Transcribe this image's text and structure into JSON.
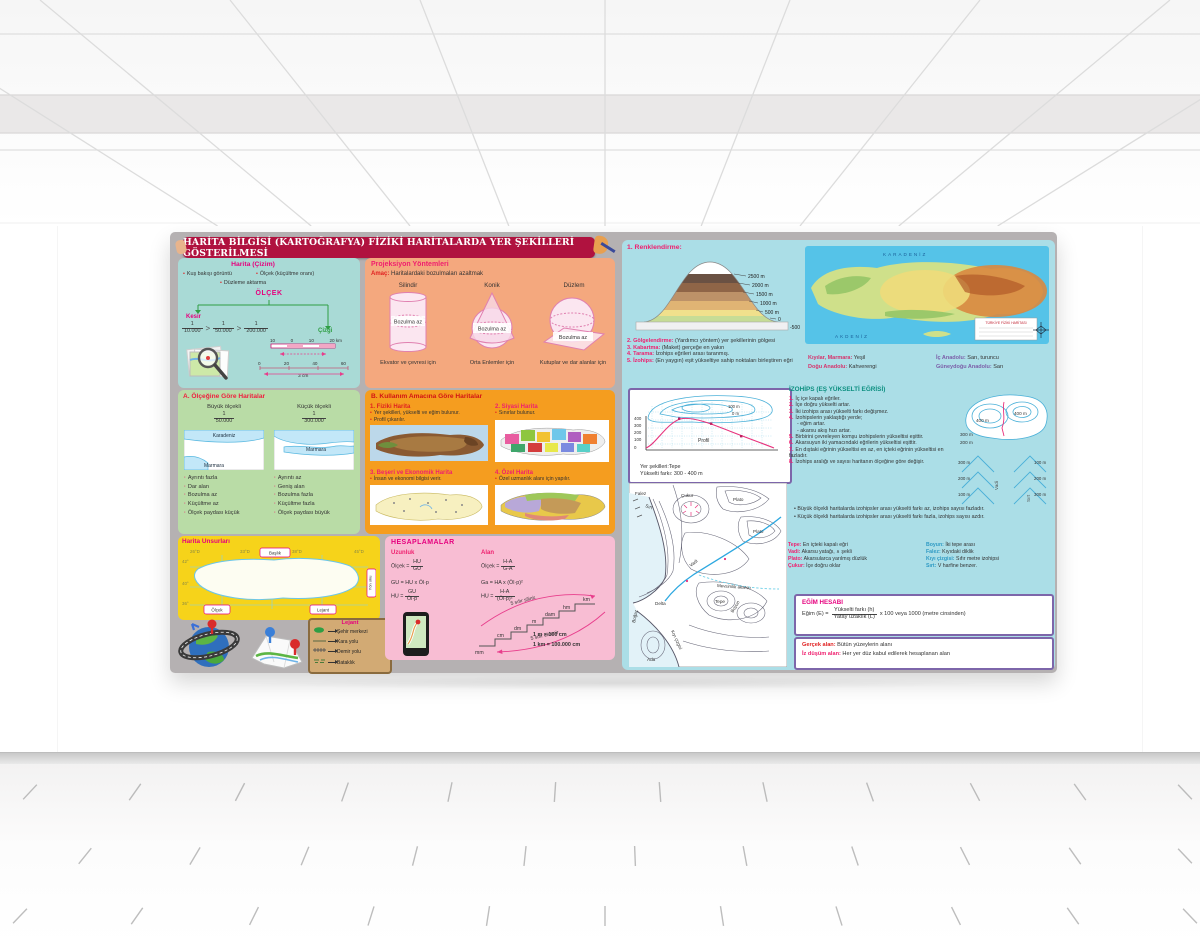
{
  "poster": {
    "title": "HARİTA BİLGİSİ (KARTOĞRAFYA) FİZİKİ HARİTALARDA YER ŞEKİLLERİ GÖSTERİLMESİ",
    "harita_cizim": {
      "title": "Harita (Çizim)",
      "bullets": [
        "Kuş bakışı görüntü",
        "Ölçek (küçültme oranı)",
        "Düzleme aktarma"
      ],
      "olcek": "ÖLÇEK",
      "kesir": "Kesir",
      "cizgi": "Çizgi",
      "sep": ">",
      "fractions": [
        {
          "num": "1",
          "den": "10.000"
        },
        {
          "num": "1",
          "den": "50.000"
        },
        {
          "num": "1",
          "den": "200.000"
        }
      ],
      "bar1": {
        "ticks": [
          "10",
          "0",
          "10",
          "20 km"
        ],
        "note": "3 cm"
      },
      "bar2": {
        "ticks": [
          "0",
          "20",
          "40",
          "60"
        ],
        "note": "6 cm"
      }
    },
    "olcegine": {
      "title": "A. Ölçeğine Göre Haritalar",
      "left": {
        "heading": "Büyük ölçekli",
        "num": "1",
        "den": "50.000",
        "sea_top": "Karadeniz",
        "sea_bottom": "Marmara",
        "bullets": [
          "Ayrıntı fazla",
          "Dar alan",
          "Bozulma az",
          "Küçültme az",
          "Ölçek paydası küçük"
        ]
      },
      "right": {
        "heading": "Küçük ölçekli",
        "num": "1",
        "den": "300.000",
        "sea_mid": "Marmara",
        "bullets": [
          "Ayrıntı az",
          "Geniş alan",
          "Bozulma fazla",
          "Küçültme fazla",
          "Ölçek paydası büyük"
        ]
      }
    },
    "unsurlar": {
      "title": "Harita Unsurları",
      "top_coords": [
        "26°D",
        "33°D",
        "38°D",
        "45°D"
      ],
      "left_coords": [
        "42°",
        "40°",
        "36°"
      ],
      "baslik": "Başlık",
      "olcek": "Ölçek",
      "lejant": "Lejant",
      "yon": "Yön oku"
    },
    "lejant": {
      "title": "Lejant",
      "items": [
        "Şehir merkezi",
        "Kara yolu",
        "Demir yolu",
        "Bataklık"
      ]
    },
    "projeksiyon": {
      "title": "Projeksiyon Yöntemleri",
      "amac_label": "Amaç:",
      "amac": "Haritalardaki bozulmaları azaltmak",
      "methods": [
        {
          "name": "Silindir",
          "note": "Bozulma az",
          "caption": "Ekvator ve çevresi için"
        },
        {
          "name": "Konik",
          "note": "Bozulma az",
          "caption": "Orta Enlemler için"
        },
        {
          "name": "Düzlem",
          "note": "Bozulma az",
          "caption": "Kutuplar ve dar alanlar için"
        }
      ]
    },
    "kullanim": {
      "title": "B. Kullanım Amacına Göre Haritalar",
      "items": [
        {
          "name": "1. Fiziki Harita",
          "b1": "Yer şekilleri, yükselti ve eğim bulunur.",
          "b2": "Profil çıkarılır."
        },
        {
          "name": "2. Siyasi Harita",
          "b1": "Sınırlar bulunur."
        },
        {
          "name": "3. Beşeri ve Ekonomik Harita",
          "b1": "İnsan ve ekonomi bilgisi verir."
        },
        {
          "name": "4. Özel Harita",
          "b1": "Özel uzmanlık alanı için yapılır."
        }
      ]
    },
    "hesaplamalar": {
      "title": "HESAPLAMALAR",
      "uzunluk": "Uzunluk",
      "alan": "Alan",
      "u1": {
        "lhs": "Ölçek =",
        "num": "HU",
        "den": "GU"
      },
      "u2": "GU = HU x Öl·p",
      "u3": {
        "lhs": "HU =",
        "num": "GU",
        "den": "Öl·p"
      },
      "a1": {
        "lhs": "Ölçek =",
        "num": "H-A",
        "den": "G-A"
      },
      "a2": "Ga = HA x (Öl·p)²",
      "a3": {
        "lhs": "HU =",
        "num": "H-A",
        "den": "(Öl·p)²"
      },
      "stairs": [
        "mm",
        "cm",
        "dm",
        "m",
        "dam",
        "hm",
        "km"
      ],
      "up": "5 sıfır silinir.",
      "down": "5 sıfır eklenir.",
      "eq1": "1 m = 100 cm",
      "eq2": "1 km = 100.000 cm"
    },
    "renklendirme": {
      "title": "1. Renklendirme:",
      "labels": [
        "2500 m",
        "2000 m",
        "1500 m",
        "1000 m",
        "500 m",
        "0",
        "-500"
      ]
    },
    "yontemler": [
      {
        "label": "2. Gölgelendirme:",
        "text": "(Yardımcı yöntem) yer şekillerinin gölgesi"
      },
      {
        "label": "3. Kabartma:",
        "text": "(Maket) gerçeğe en yakın"
      },
      {
        "label": "4. Tarama:",
        "text": "İzohips eğrileri arası taranmış."
      },
      {
        "label": "5. İzohips:",
        "text": "(En yaygın) eşit yükseltiye sahip noktaları birleştiren eğri"
      }
    ],
    "renk_anahtari": [
      {
        "label": "Kıyılar, Marmara:",
        "value": "Yeşil"
      },
      {
        "label": "İç Anadolu:",
        "value": "Sarı, turuncu"
      },
      {
        "label": "Doğu Anadolu:",
        "value": "Kahverengi"
      },
      {
        "label": "Güneydoğu Anadolu:",
        "value": "Sarı"
      }
    ],
    "fiziki_harita": {
      "sea_top": "KARADENİZ",
      "sea_bottom": "AKDENİZ",
      "legend_title": "TÜRKİYE FİZİKİ HARİTASI"
    },
    "profil": {
      "c100": "100 m",
      "c0": "0 m",
      "axis": [
        "400",
        "300",
        "200",
        "100",
        "0"
      ],
      "label": "Profil",
      "cap1": "Yer şekilleri:Tepe",
      "cap2": "Yükselti farkı: 300 - 400 m"
    },
    "izohips": {
      "title": "İZOHİPS (EŞ YÜKSELTİ EĞRİSİ)",
      "items": [
        {
          "n": "1.",
          "t": "İç içe kapalı eğriler."
        },
        {
          "n": "2.",
          "t": "İçe doğru yükselti artar."
        },
        {
          "n": "3.",
          "t": "İki izohips arası yükselti farkı değişmez."
        },
        {
          "n": "4.",
          "t": "İzohipslerin yaklaştığı yerde;",
          "s1": "- eğim artar.",
          "s2": "- akarsu akış hızı artar."
        },
        {
          "n": "5.",
          "t": "Birbirini çevreleyen komşu izohipslerin yükseltisi eşittir."
        },
        {
          "n": "6.",
          "t": "Akarsuyun iki yamacındaki eğrilerin yükseltisi eşittir."
        },
        {
          "n": "7.",
          "t": "En dıştaki eğrinin yükseltisi en az, en içteki eğrinin yükseltisi en fazladır."
        },
        {
          "n": "8.",
          "t": "İzohips aralığı ve sayısı haritanın ölçeğine göre değişir."
        }
      ],
      "sub1": "• Büyük ölçekli haritalarda izohipsler arası yükselti farkı az, izohips sayısı fazladır.",
      "sub2": "• Küçük ölçekli haritalarda izohipsler arası yükselti farkı fazla, izohips sayısı azdır.",
      "hill_labels": [
        "400 m",
        "300 m",
        "200 m",
        "400 m"
      ],
      "vadi": {
        "label": "Vadi",
        "marks": [
          "300 m",
          "200 m",
          "100 m"
        ]
      },
      "sirt": {
        "label": "Sırt",
        "marks": [
          "100 m",
          "200 m",
          "300 m"
        ]
      }
    },
    "tanimlar": {
      "left": [
        {
          "k": "Tepe:",
          "v": "En içteki kapalı eğri"
        },
        {
          "k": "Vadi:",
          "v": "Akarsu yatağı, ∧ şekli"
        },
        {
          "k": "Plato:",
          "v": "Akarsularca yarılmış düzlük"
        },
        {
          "k": "Çukur:",
          "v": "İçe doğru oklar"
        }
      ],
      "right": [
        {
          "k": "Boyun:",
          "v": "İki tepe arası"
        },
        {
          "k": "Falez:",
          "v": "Kıyıdaki diklik"
        },
        {
          "k": "Kıyı çizgisi:",
          "v": "Sıfır metre izohipsi"
        },
        {
          "k": "Sırt:",
          "v": "V harfine benzer."
        }
      ]
    },
    "kontur_harita": {
      "labels": [
        "Falez",
        "Sırt",
        "Çukur",
        "Plato",
        "Plato",
        "Vadi",
        "Mevsimlik akarsu",
        "Delta",
        "Boğaz",
        "Kıyı çizgisi",
        "Tepe",
        "Boyun",
        "Ada"
      ]
    },
    "egim": {
      "title": "EĞİM HESABI",
      "lhs": "Eğim (E) =",
      "num": "Yükselti farkı (h)",
      "den": "Yatay uzaklık (L)",
      "rhs": "x 100 veya 1000 (metre cinsinden)"
    },
    "alanlar": [
      {
        "k": "Gerçek alan:",
        "v": "Bütün yüzeylerin alanı"
      },
      {
        "k": "İz düşüm alan:",
        "v": "Her yer düz kabul edilerek hesaplanan alan"
      }
    ]
  }
}
